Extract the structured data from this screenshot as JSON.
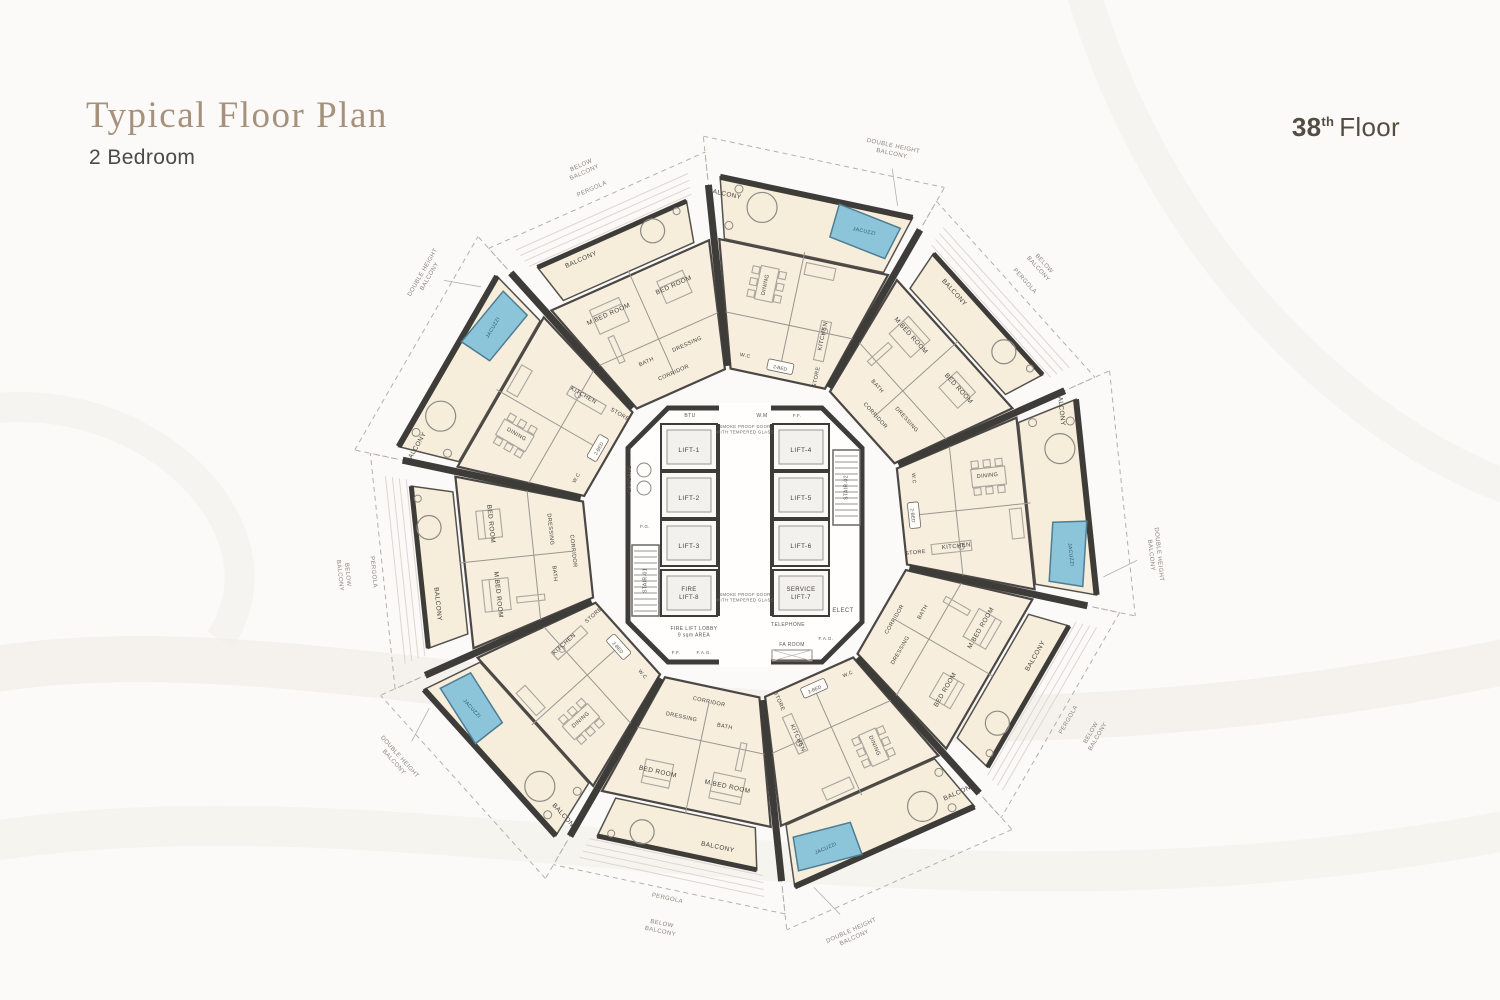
{
  "header": {
    "title": "Typical Floor Plan",
    "subtitle": "2 Bedroom"
  },
  "floor_badge": {
    "number": "38",
    "suffix": "th",
    "label": "Floor"
  },
  "plan": {
    "core": {
      "lifts_left": [
        "LIFT-1",
        "LIFT-2",
        "LIFT-3"
      ],
      "fire_lift": [
        "FIRE",
        "LIFT-8"
      ],
      "lifts_right": [
        "LIFT-4",
        "LIFT-5",
        "LIFT-6"
      ],
      "service_lift": [
        "SERVICE",
        "LIFT-7"
      ],
      "lobby": [
        "FIRE LIFT LOBBY",
        "9 sqm AREA"
      ],
      "door_note": [
        "SMOKE PROOF DOOR",
        "WITH TEMPERED GLASS"
      ],
      "stairs": [
        "STAIR-01",
        "STAIR-02"
      ],
      "utility": {
        "garbage": "GARBAGE",
        "btu": "BTU",
        "wm": "W.M",
        "ff": "F.F.",
        "fag": "F.A.G.",
        "fg": "F.G.",
        "elect": "ELECT",
        "telephone": "TELEPHONE",
        "fa_room": "FA ROOM"
      }
    },
    "units": {
      "living_wing": {
        "rooms": {
          "dining": "DINING",
          "kitchen": "KITCHEN",
          "store": "STORE",
          "wc": "W.C"
        },
        "tag": "2-BED"
      },
      "bedroom_wing": {
        "rooms": {
          "master": "M.BED ROOM",
          "bed": "BED ROOM",
          "bath": "BATH",
          "dressing": "DRESSING",
          "corridor": "CORRIDOR"
        }
      }
    },
    "balcony": {
      "label": "BALCONY",
      "jacuzzi": "JACUZZI"
    },
    "perimeter": {
      "double_height": [
        "DOUBLE HEIGHT",
        "BALCONY"
      ],
      "below": [
        "BELOW",
        "BALCONY"
      ],
      "pergola": "PERGOLA"
    }
  },
  "colors": {
    "title": "#a6927c",
    "text": "#45423e",
    "tiny": "#5a5651",
    "muted": "#8a857d",
    "wall": "#3e3c39",
    "floor": "#f7eede",
    "balcony_floor": "#f6edda",
    "jacuzzi": "#8cc4d9",
    "jacuzzi_border": "#4e7d94",
    "line": "#9a968f",
    "furniture": "#aaa69e",
    "dashed": "#b5b1a9",
    "hatch": "#dcd8d0",
    "wave": "#f1eee8",
    "background": "#fbfaf8"
  }
}
